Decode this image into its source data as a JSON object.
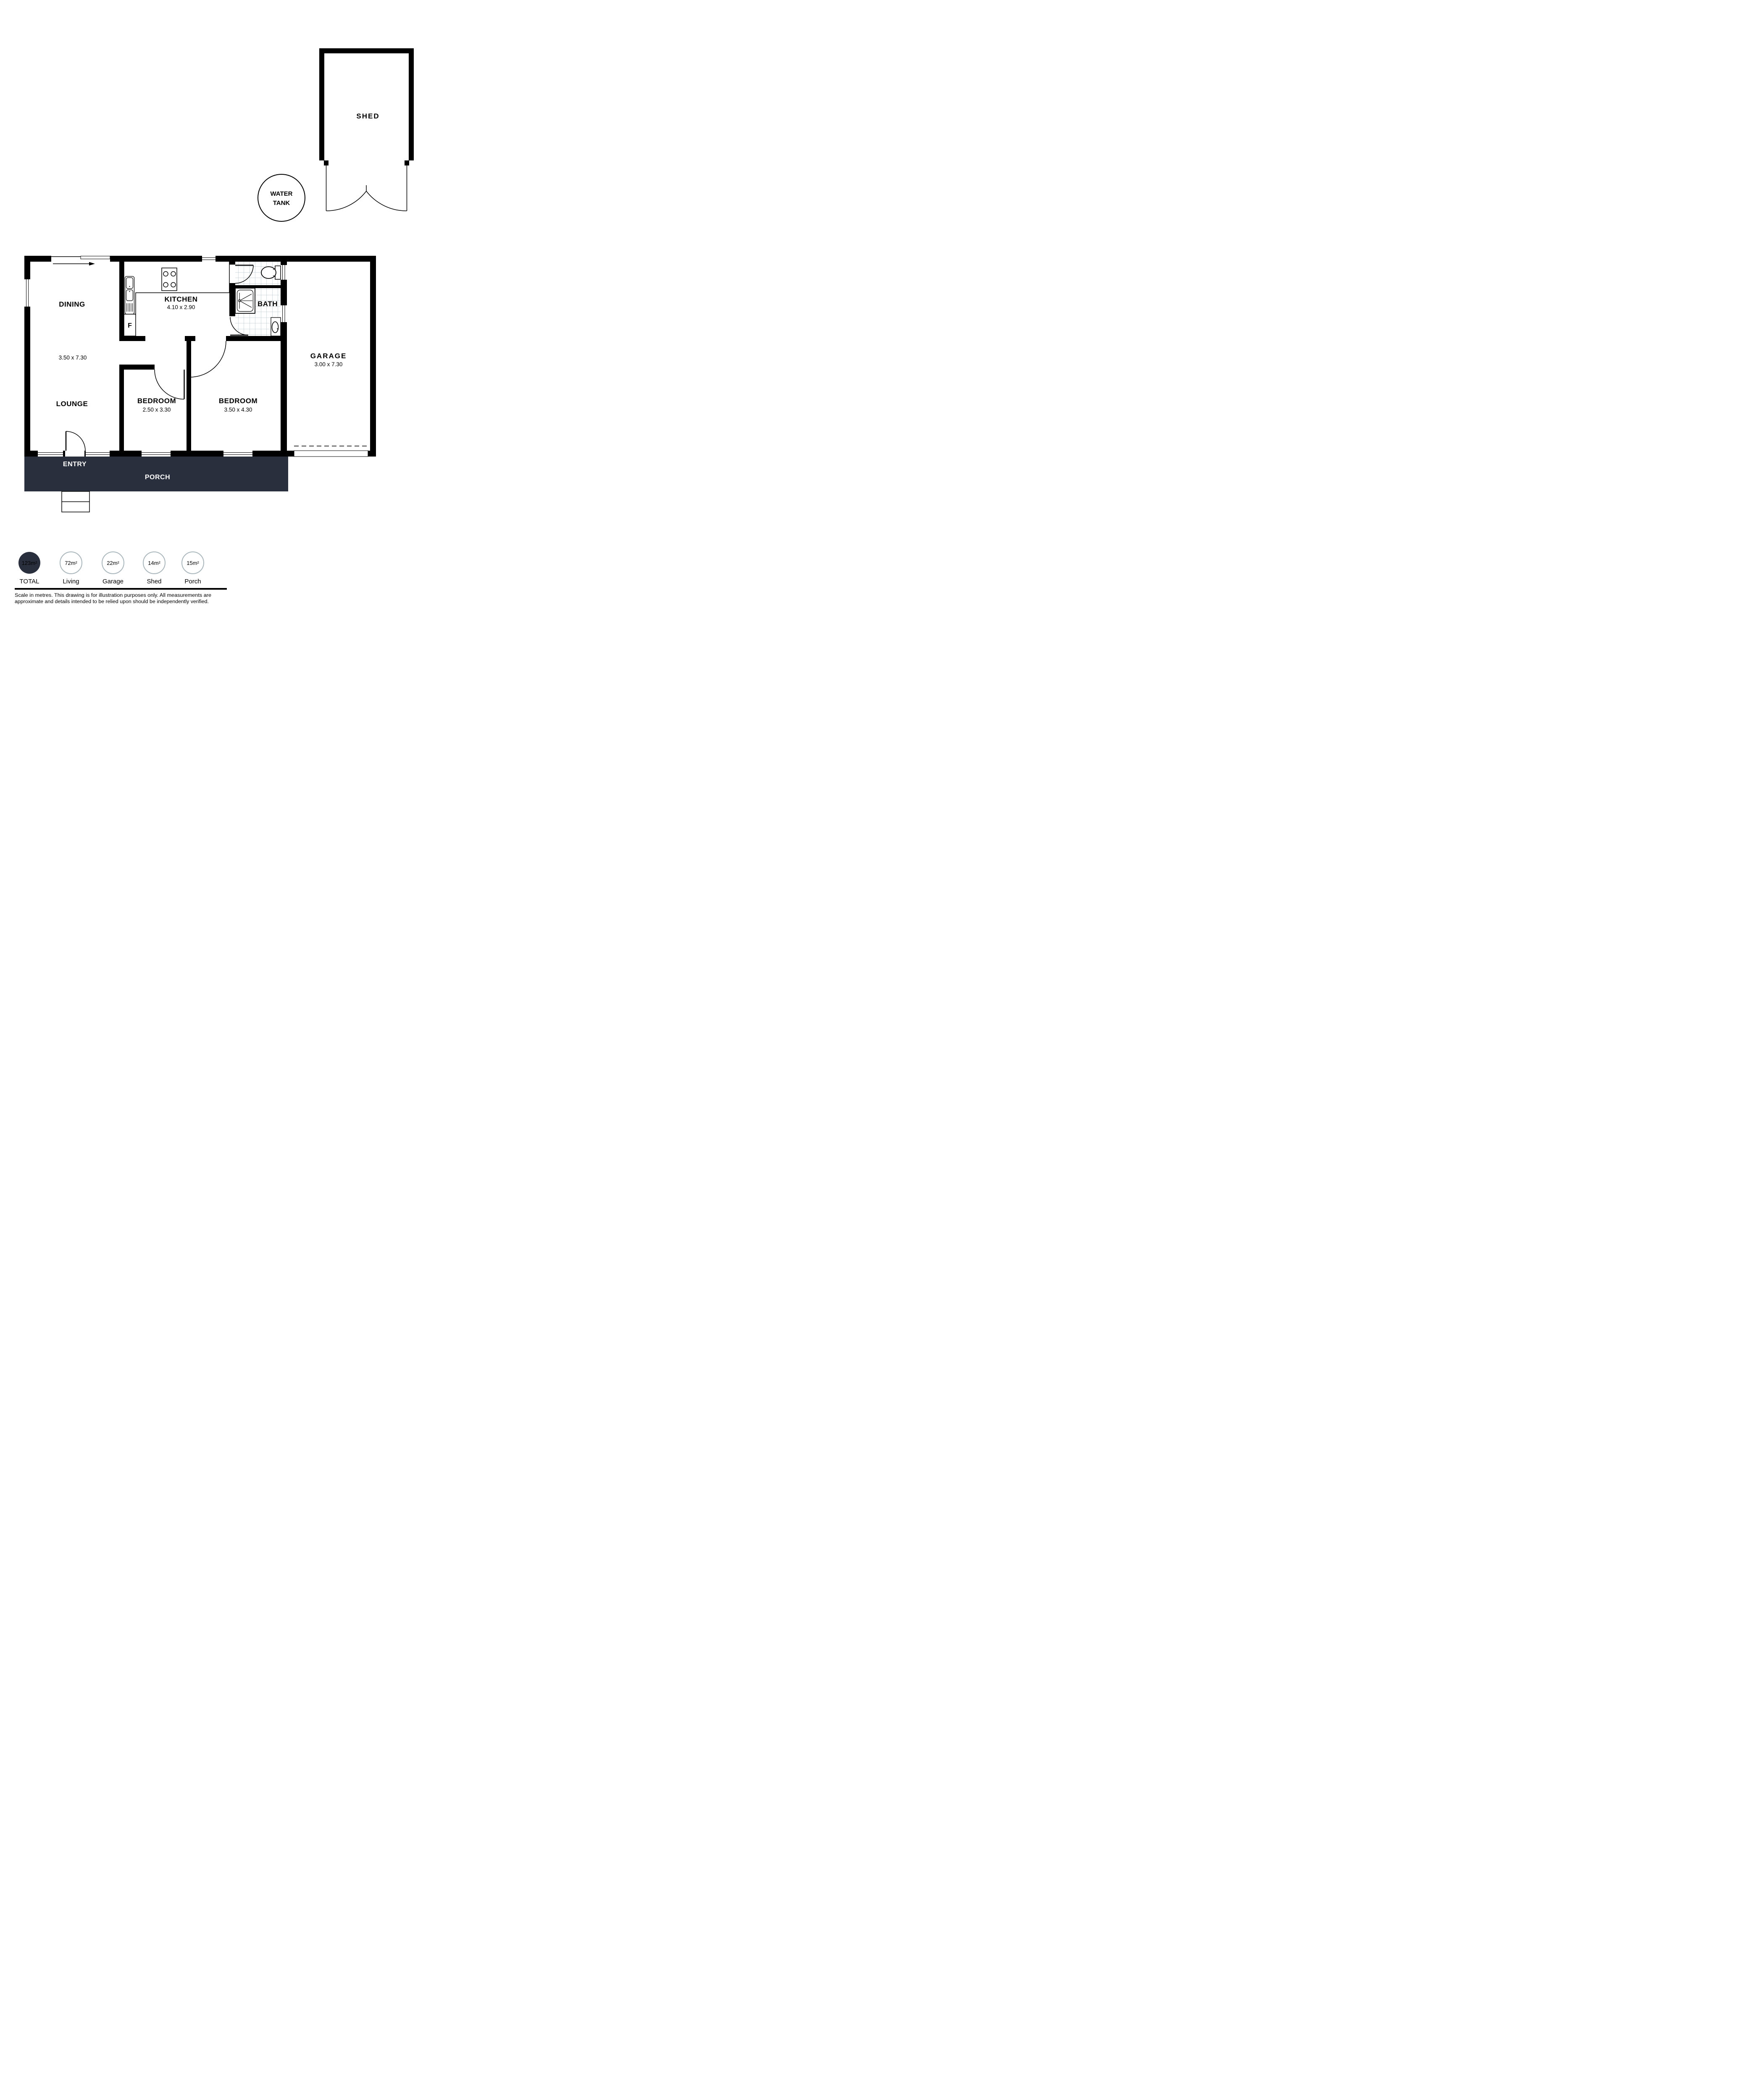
{
  "shed": {
    "label": "SHED"
  },
  "water_tank": {
    "line1": "WATER",
    "line2": "TANK"
  },
  "house": {
    "dining": {
      "label": "DINING"
    },
    "living_dims": "3.50 x 7.30",
    "kitchen": {
      "label": "KITCHEN",
      "dims": "4.10 x 2.90"
    },
    "bath": {
      "label": "BATH"
    },
    "garage": {
      "label": "GARAGE",
      "dims": "3.00 x 7.30"
    },
    "lounge": {
      "label": "LOUNGE"
    },
    "bedroom_small": {
      "label": "BEDROOM",
      "dims": "2.50 x 3.30"
    },
    "bedroom_large": {
      "label": "BEDROOM",
      "dims": "3.50 x 4.30"
    },
    "entry": {
      "label": "ENTRY"
    },
    "porch": {
      "label": "PORCH"
    },
    "fridge": "F"
  },
  "legend": {
    "items": [
      {
        "value": "123m²",
        "label": "TOTAL",
        "filled": true
      },
      {
        "value": "72m²",
        "label": "Living",
        "filled": false
      },
      {
        "value": "22m²",
        "label": "Garage",
        "filled": false
      },
      {
        "value": "14m²",
        "label": "Shed",
        "filled": false
      },
      {
        "value": "15m²",
        "label": "Porch",
        "filled": false
      }
    ]
  },
  "footer": {
    "line1": "Scale in metres. This drawing is for illustration purposes only. All measurements are",
    "line2": "approximate and details intended to be relied upon should be independently verified."
  },
  "colors": {
    "accent": "#2a2f3e",
    "tile_line": "#a9bcc6",
    "circle_outline": "#a9b6bc",
    "wall": "#000000"
  }
}
